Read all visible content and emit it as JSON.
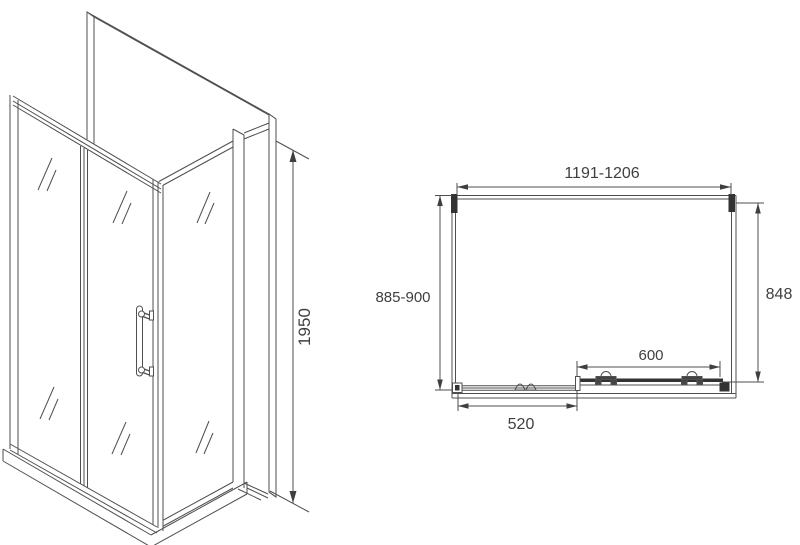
{
  "page": {
    "background": "#ffffff"
  },
  "drawing": {
    "type": "shower-enclosure-technical-drawing",
    "line_color": "#4f4f4f",
    "dark_fill": "#333333",
    "text_color": "#3f3f3f",
    "isometric_view": {
      "height": "1950"
    },
    "plan_view": {
      "overall_width": "1191-1206",
      "left_depth": "885-900",
      "right_depth": "848",
      "door_width": "600",
      "fixed_panel_width": "520"
    }
  }
}
